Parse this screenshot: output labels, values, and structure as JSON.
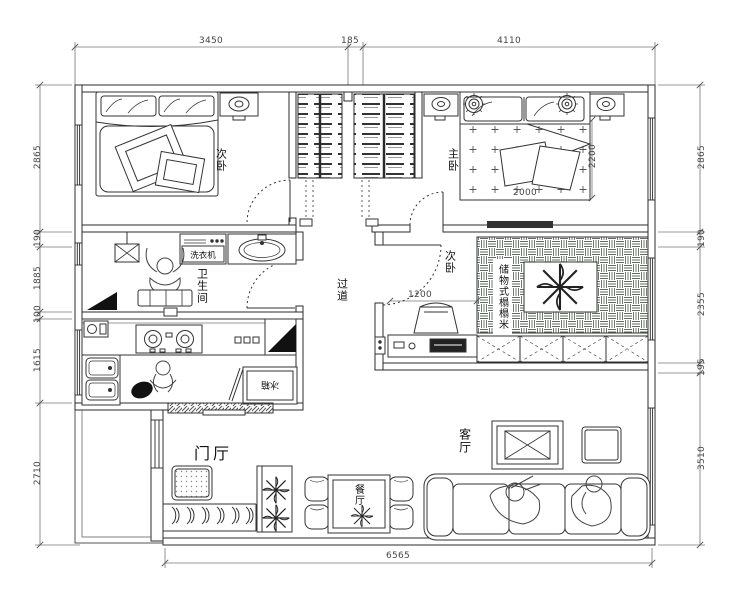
{
  "dimensions": {
    "top": [
      "3450",
      "185",
      "4110"
    ],
    "left": [
      "2865",
      "190",
      "1885",
      "100",
      "1615",
      "2710"
    ],
    "right": [
      "2865",
      "190",
      "2355",
      "195",
      "3510"
    ],
    "bottom": [
      "6565"
    ],
    "interior": {
      "master_bed_width": "2000",
      "master_bed_length": "2200",
      "tatami_clearance": "1200"
    }
  },
  "rooms": {
    "bedroom_top_left": "次卧",
    "master_bedroom": "主卧",
    "bedroom_tatami": "次卧",
    "bathroom": "卫生间",
    "hallway": "过道",
    "living_room": "客厅",
    "dining_room": "餐厅",
    "foyer": "门厅"
  },
  "fixtures": {
    "washing_machine": "洗衣机",
    "fridge": "冰箱",
    "tatami_cabinet": "储物式榻榻米"
  },
  "colors": {
    "line": "#2b2b2b",
    "dark_fill": "#111111",
    "paper": "#ffffff",
    "dim_line": "#666666"
  }
}
